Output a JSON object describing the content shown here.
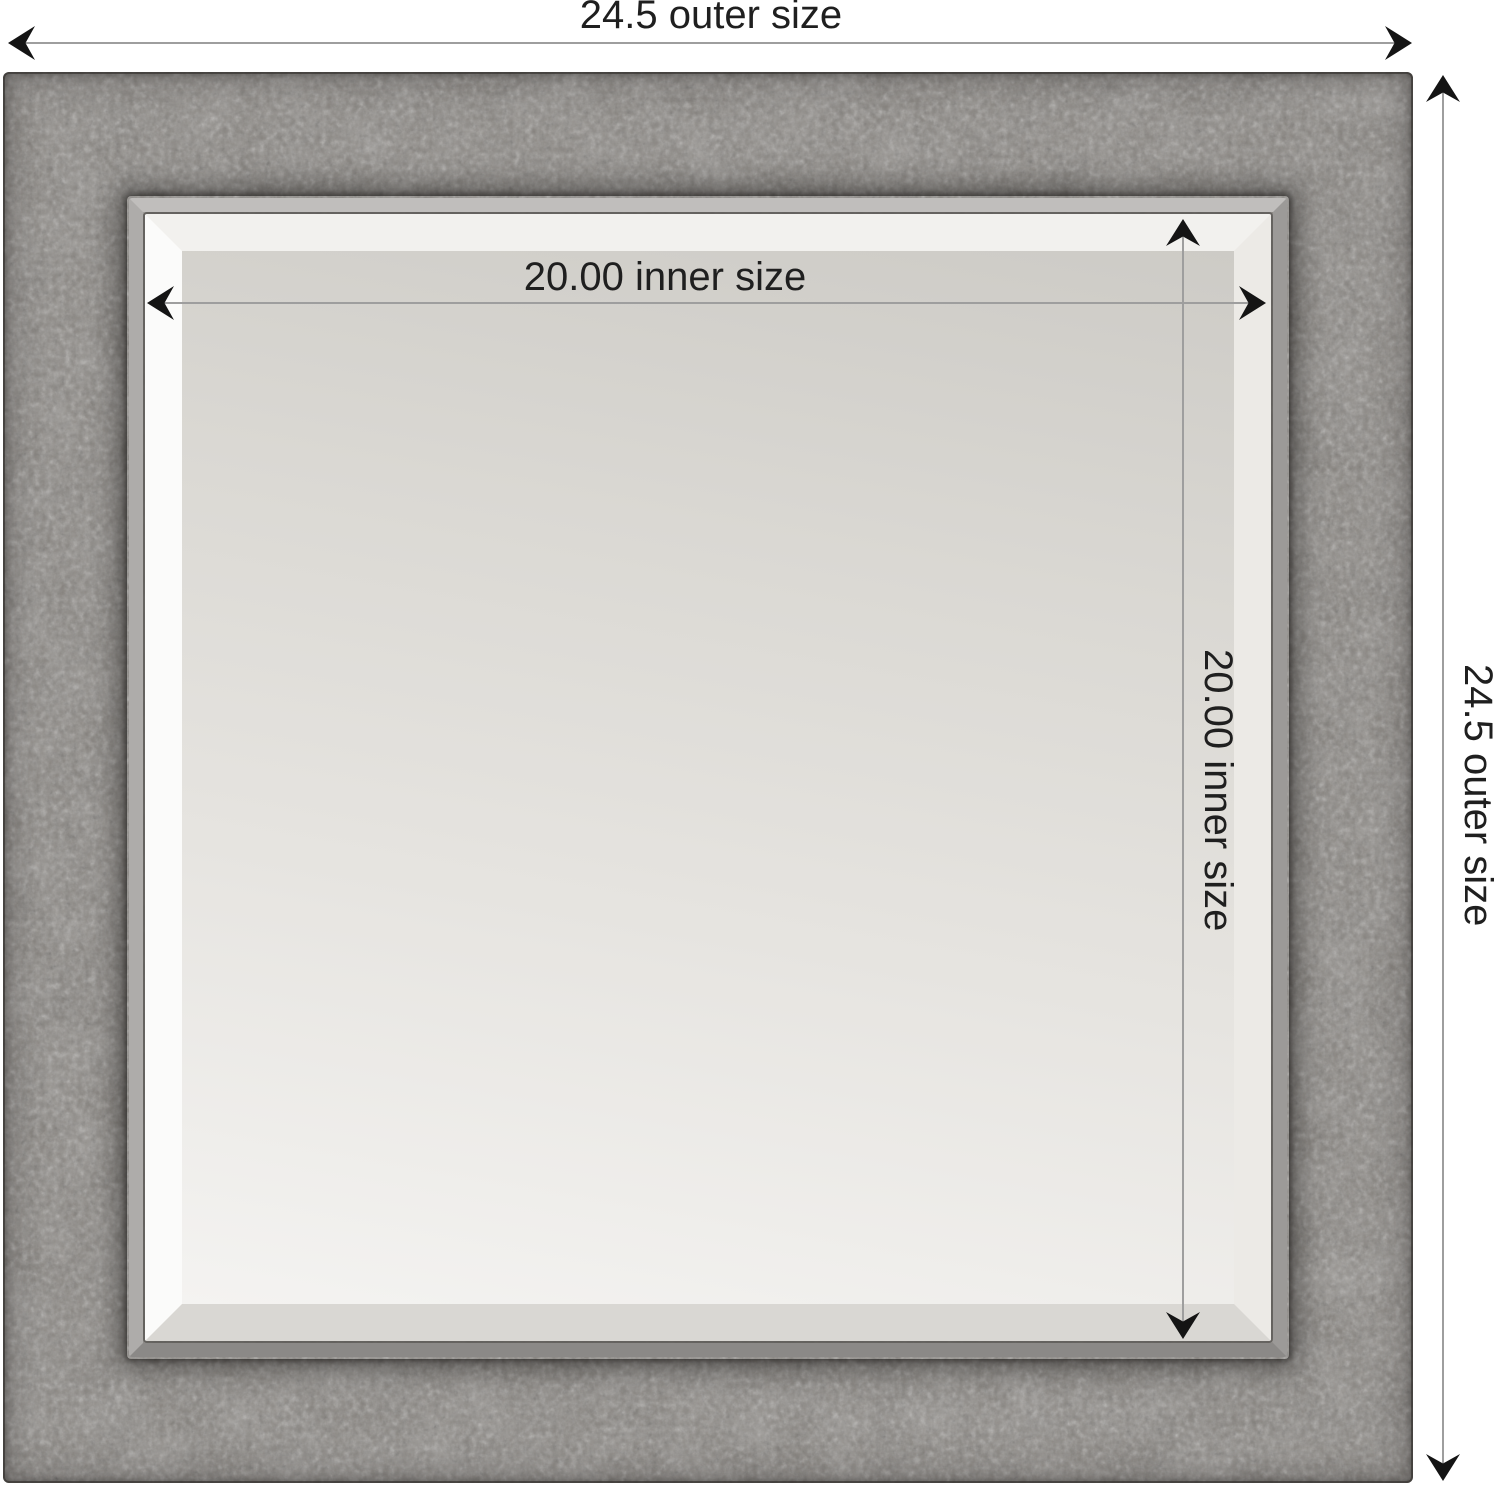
{
  "diagram": {
    "kind": "product-dimension-diagram",
    "subject": "square beveled wall mirror with rustic pewter-gray frame",
    "labels": {
      "outer_width": "24.5 outer size",
      "outer_height": "24.5 outer size",
      "inner_width": "20.00 inner size",
      "inner_height": "20.00 inner size"
    },
    "values": {
      "outer_size": 24.5,
      "inner_size": 20.0
    }
  },
  "colors": {
    "background": "#ffffff",
    "frame_base": "#837f7a",
    "frame_dark_edge": "#4a4744",
    "lip_light": "#c0bebc",
    "lip_mid": "#9c9a98",
    "lip_mid2": "#aeacaa",
    "lip_dark": "#8b8987",
    "glass_dark": "#cdcbc6",
    "glass_light": "#f4f3f1",
    "bevel_white": "#fbfbfa",
    "dimension_line": "#9e9e9e",
    "arrow": "#141414",
    "text": "#1f1f1f"
  }
}
